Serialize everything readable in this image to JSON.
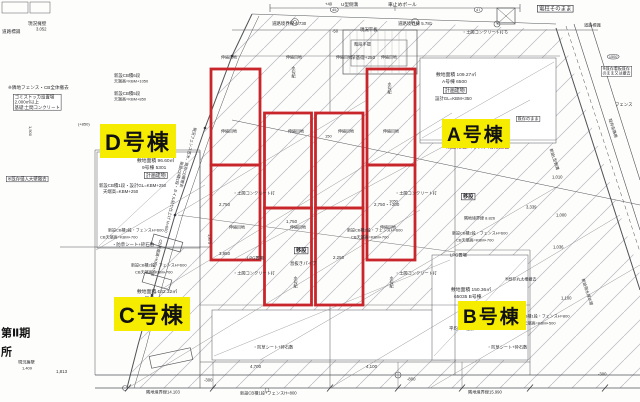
{
  "colors": {
    "overlay_red": "#c8262b",
    "highlight_yellow": "#f6ec00",
    "line_dark": "#505257",
    "hatch_gray": "#b9b9bf",
    "note_brown": "#7a3b2e"
  },
  "buildings": {
    "d": {
      "label": "D号棟",
      "area_line": "敷地面積 96.60㎡",
      "unit_line": "9号棟 5301",
      "plan_label": "計画建物",
      "note1": "新設CB積1段・設計GL=KBM+250",
      "note2": "天端高=KBM+250"
    },
    "a": {
      "label": "A号棟",
      "area_line": "敷地面積 109.27㎡",
      "unit_line": "A号棟 6500",
      "plan_label": "計画建物",
      "note1": "設計GL=KBM+350",
      "demolition_note": "既設物置ハウス、階段撤去"
    },
    "c": {
      "label": "C号棟",
      "area_line": "敷地面積 142.32㎡",
      "unit_line": "C号棟 6501",
      "note1": "平均GL=設計GL+20"
    },
    "b": {
      "label": "B号棟",
      "area_line": "敷地面積 150.36㎡",
      "unit_line": "65035 B号棟",
      "note1": "平均GL=設計GL-20"
    }
  },
  "annotations": [
    {
      "t": "現況擁壁",
      "x": 28,
      "y": 21,
      "s": 4.6
    },
    {
      "t": "3.052",
      "x": 36,
      "y": 27,
      "s": 4.2
    },
    {
      "t": "道路標識",
      "x": 2,
      "y": 29,
      "s": 4.6
    },
    {
      "t": "+40",
      "x": 325,
      "y": 2,
      "s": 4.2
    },
    {
      "t": "U型側溝",
      "x": 341,
      "y": 2,
      "s": 4.6
    },
    {
      "t": "車止めポール",
      "x": 388,
      "y": 2,
      "s": 4.8
    },
    {
      "t": "道路境界線 2.730",
      "x": 272,
      "y": 21,
      "s": 4.4
    },
    {
      "t": "道路境界線 5.781",
      "x": 398,
      "y": 21,
      "s": 4.4
    },
    {
      "t": "現況平板",
      "x": 360,
      "y": 27,
      "s": 4.4
    },
    {
      "t": "-50",
      "x": 332,
      "y": 29,
      "s": 4.2
    },
    {
      "t": "45",
      "x": 330,
      "y": 7,
      "s": 4,
      "cls": "circ"
    },
    {
      "t": "47",
      "x": 474,
      "y": 7,
      "s": 4,
      "cls": "circ"
    },
    {
      "t": "電柱そのまま",
      "x": 537,
      "y": 5,
      "s": 5.4,
      "cls": "box"
    },
    {
      "t": "道路標識",
      "x": 584,
      "y": 23,
      "s": 4.2
    },
    {
      "t": "深基礎+250",
      "x": 351,
      "y": 55,
      "s": 4.6
    },
    {
      "t": "・土間コンクリート打ち",
      "x": 462,
      "y": 30,
      "s": 4.2
    },
    {
      "t": "階段手摺",
      "x": 354,
      "y": 42,
      "s": 4.2
    },
    {
      "t": "新設CB積6段",
      "x": 114,
      "y": 73,
      "s": 4.4
    },
    {
      "t": "天端高=KBM+1050",
      "x": 114,
      "y": 79,
      "s": 4
    },
    {
      "t": "新設CB積5段",
      "x": 114,
      "y": 91,
      "s": 4.4
    },
    {
      "t": "天端高=KBM+850",
      "x": 114,
      "y": 97,
      "s": 4
    },
    {
      "t": "※隣地フェンス・CB全体撤去",
      "x": 8,
      "y": 85,
      "s": 4.6
    },
    {
      "t": "ゴミストッカ設置場\n2.000㎡以上\n基礎:土間コンクリート",
      "x": 13,
      "y": 94,
      "s": 4.4,
      "cls": "box"
    },
    {
      "t": "(+850)",
      "x": 78,
      "y": 122,
      "s": 4
    },
    {
      "t": "1,500",
      "x": 28,
      "y": 126,
      "s": 4,
      "cls": "vert"
    },
    {
      "t": "※既存侵入大壁撤去",
      "x": 6,
      "y": 176,
      "s": 4.4,
      "cls": "box"
    },
    {
      "t": "第Ⅱ期",
      "x": 1,
      "y": 327,
      "s": 11,
      "cls": "big"
    },
    {
      "t": "所",
      "x": 1,
      "y": 346,
      "s": 11,
      "cls": "big"
    },
    {
      "t": "伸縮目地",
      "x": 221,
      "y": 55,
      "s": 4
    },
    {
      "t": "伸縮目地",
      "x": 286,
      "y": 55,
      "s": 4
    },
    {
      "t": "伸縮目地",
      "x": 336,
      "y": 55,
      "s": 4
    },
    {
      "t": "伸縮目地",
      "x": 381,
      "y": 55,
      "s": 4
    },
    {
      "t": "伸縮目地",
      "x": 221,
      "y": 129,
      "s": 4
    },
    {
      "t": "伸縮目地",
      "x": 288,
      "y": 129,
      "s": 4
    },
    {
      "t": "伸縮目地",
      "x": 338,
      "y": 129,
      "s": 4
    },
    {
      "t": "伸縮目地",
      "x": 383,
      "y": 129,
      "s": 4
    },
    {
      "t": "伸縮目地",
      "x": 229,
      "y": 225,
      "s": 4
    },
    {
      "t": "伸縮目地",
      "x": 290,
      "y": 225,
      "s": 4
    },
    {
      "t": "伸縮目地",
      "x": 380,
      "y": 225,
      "s": 4
    },
    {
      "t": "水勾配",
      "x": 291,
      "y": 66,
      "s": 4,
      "cls": "vert"
    },
    {
      "t": "水勾配",
      "x": 387,
      "y": 82,
      "s": 4,
      "cls": "vert"
    },
    {
      "t": "水勾配",
      "x": 293,
      "y": 276,
      "s": 4,
      "cls": "vert"
    },
    {
      "t": "水勾配",
      "x": 389,
      "y": 276,
      "s": 4,
      "cls": "vert"
    },
    {
      "t": "・土間コンクリート打",
      "x": 233,
      "y": 191,
      "s": 4.2
    },
    {
      "t": "・土間コンクリート打",
      "x": 395,
      "y": 191,
      "s": 4.2
    },
    {
      "t": "・土間コンクリート打",
      "x": 233,
      "y": 271,
      "s": 4.2
    },
    {
      "t": "・土間コンクリート打",
      "x": 395,
      "y": 271,
      "s": 4.2
    },
    {
      "t": "移設",
      "x": 294,
      "y": 247,
      "s": 5.2,
      "cls": "box bold"
    },
    {
      "t": "移設",
      "x": 461,
      "y": 193,
      "s": 5.2,
      "cls": "box bold"
    },
    {
      "t": "息抜きパイプ",
      "x": 290,
      "y": 261,
      "s": 4.4
    },
    {
      "t": "LPG置場",
      "x": 247,
      "y": 256,
      "s": 4.2
    },
    {
      "t": "LPG置場",
      "x": 450,
      "y": 253,
      "s": 4.2
    },
    {
      "t": "既存のまま",
      "x": 516,
      "y": 116,
      "s": 4.2,
      "cls": "box"
    },
    {
      "t": "新設CB積2段・フェンスH=600",
      "x": 452,
      "y": 231,
      "s": 4
    },
    {
      "t": "CB天端高=KBM+700",
      "x": 456,
      "y": 238,
      "s": 4
    },
    {
      "t": "新設CB積2段・フェンスH=600",
      "x": 347,
      "y": 228,
      "s": 4
    },
    {
      "t": "CB天端高=KBM+700",
      "x": 351,
      "y": 235,
      "s": 4
    },
    {
      "t": "新設CB積3段・フェンスH=600",
      "x": 108,
      "y": 228,
      "s": 4
    },
    {
      "t": "CB天端高=KBM+700",
      "x": 100,
      "y": 235,
      "s": 4
    },
    {
      "t": "新設CB積2段・フェンスH=600",
      "x": 131,
      "y": 263,
      "s": 4
    },
    {
      "t": "CB天端高=KBM+700",
      "x": 135,
      "y": 270,
      "s": 4
    },
    {
      "t": "新設CB積1段・フェンスH=800",
      "x": 514,
      "y": 314,
      "s": 4
    },
    {
      "t": "CB天端高=KBM+500",
      "x": 518,
      "y": 321,
      "s": 4
    },
    {
      "t": "・防草シート+砕石敷",
      "x": 112,
      "y": 242,
      "s": 4.4
    },
    {
      "t": "・防草シート+砕石敷",
      "x": 253,
      "y": 345,
      "s": 4.2
    },
    {
      "t": "・防草シート+砕石敷",
      "x": 487,
      "y": 345,
      "s": 4.2
    },
    {
      "t": "※既存丸太柵撤去",
      "x": 505,
      "y": 277,
      "s": 4
    },
    {
      "t": "隣地境界線 8.826",
      "x": 464,
      "y": 216,
      "s": 4
    },
    {
      "t": "新設CB積1段+フェンスH=800",
      "x": 240,
      "y": 391,
      "s": 4.2
    },
    {
      "t": "隣地境界線14.103",
      "x": 146,
      "y": 390,
      "s": 4.2
    },
    {
      "t": "隣地境界線15.990",
      "x": 468,
      "y": 390,
      "s": 4.2
    },
    {
      "t": "4,700",
      "x": 250,
      "y": 364,
      "s": 4.4
    },
    {
      "t": "4,100",
      "x": 366,
      "y": 364,
      "s": 4.4
    },
    {
      "t": "1,813",
      "x": 56,
      "y": 369,
      "s": 4.4
    },
    {
      "t": "現況擁壁",
      "x": 18,
      "y": 360,
      "s": 4.2
    },
    {
      "t": "1,409",
      "x": 22,
      "y": 366,
      "s": 4
    },
    {
      "t": "-300",
      "x": 204,
      "y": 378,
      "s": 4.2
    },
    {
      "t": "-800",
      "x": 407,
      "y": 377,
      "s": 4.2
    },
    {
      "t": "-300",
      "x": 598,
      "y": 372,
      "s": 4.2
    },
    {
      "t": "2,750",
      "x": 219,
      "y": 202,
      "s": 4.4
    },
    {
      "t": "2,750・+200",
      "x": 374,
      "y": 202,
      "s": 4.4
    },
    {
      "t": "3,950",
      "x": 219,
      "y": 251,
      "s": 4.4
    },
    {
      "t": "1,875",
      "x": 207,
      "y": 234,
      "s": 4,
      "cls": "vert"
    },
    {
      "t": "2,250",
      "x": 333,
      "y": 255,
      "s": 4.4
    },
    {
      "t": "1,750",
      "x": 286,
      "y": 219,
      "s": 4.4
    },
    {
      "t": "1050",
      "x": 389,
      "y": 199,
      "s": 4
    },
    {
      "t": "150",
      "x": 325,
      "y": 134,
      "s": 4
    },
    {
      "t": "3,339",
      "x": 526,
      "y": 205,
      "s": 4.2
    },
    {
      "t": "1,000",
      "x": 556,
      "y": 213,
      "s": 4.2
    },
    {
      "t": "1,036",
      "x": 553,
      "y": 245,
      "s": 4.2
    },
    {
      "t": "1,100",
      "x": 561,
      "y": 296,
      "s": 4.2
    },
    {
      "t": "1,010",
      "x": 552,
      "y": 175,
      "s": 4.2
    },
    {
      "t": "1500",
      "x": 607,
      "y": 54,
      "s": 3.8,
      "cls": "circ"
    },
    {
      "t": "※既存看板既存\nのまま又は撤去",
      "x": 601,
      "y": 66,
      "s": 4,
      "cls": "box"
    },
    {
      "t": "フェンス",
      "x": 615,
      "y": 102,
      "s": 4.4
    },
    {
      "t": "新設L型側溝",
      "x": 553,
      "y": 148,
      "s": 4,
      "r": 72
    },
    {
      "t": "既存街路樹",
      "x": 612,
      "y": 118,
      "s": 4,
      "r": 72
    },
    {
      "t": "新設雨水排水管",
      "x": 585,
      "y": 278,
      "s": 4,
      "r": 72
    },
    {
      "t": "現況フェンス笠木、既存CB塀撤去",
      "x": 197,
      "y": 128,
      "s": 4,
      "r": 103
    },
    {
      "t": "新設CB積1段・タイル貼り仕上げ H=600",
      "x": 184,
      "y": 162,
      "s": 4,
      "r": 103
    },
    {
      "t": "CB天端高=KBM+500",
      "x": 163,
      "y": 240,
      "s": 4,
      "r": 103
    }
  ]
}
